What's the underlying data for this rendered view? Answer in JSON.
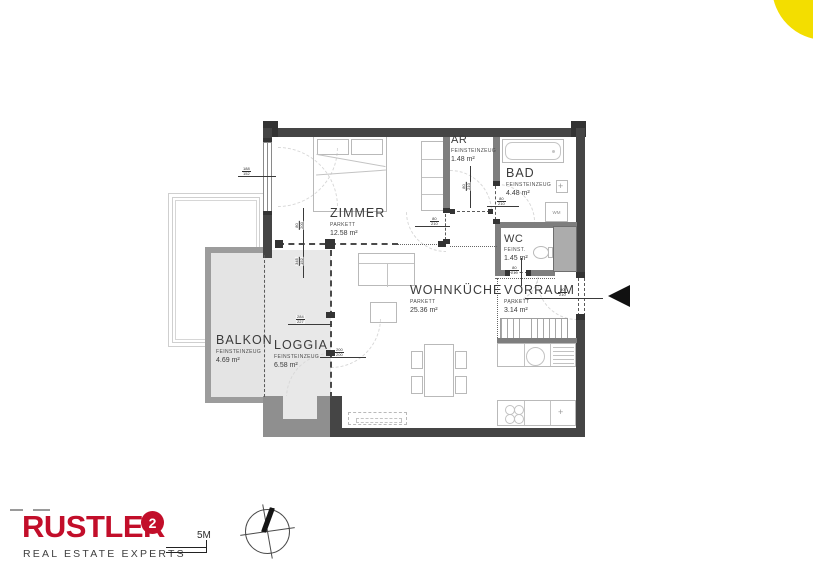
{
  "accent": {
    "corner_circle_color": "#f3de00"
  },
  "branding": {
    "logo_text": "RUSTLER",
    "logo_mark": "2",
    "tagline": "REAL ESTATE EXPERTS",
    "brand_color": "#c20e2a"
  },
  "scale_bar": {
    "label": "5M"
  },
  "rooms": [
    {
      "id": "zimmer",
      "name": "ZIMMER",
      "material": "PARKETT",
      "area": "12.58 m²"
    },
    {
      "id": "ar",
      "name": "AR",
      "material": "FEINSTEINZEUG",
      "area": "1.48 m²"
    },
    {
      "id": "bad",
      "name": "BAD",
      "material": "FEINSTEINZEUG",
      "area": "4.48 m²"
    },
    {
      "id": "wc",
      "name": "WC",
      "material": "FEINST.",
      "area": "1.45 m²"
    },
    {
      "id": "vorraum",
      "name": "VORRAUM",
      "material": "PARKETT",
      "area": "3.14 m²"
    },
    {
      "id": "wohnkueche",
      "name": "WOHNKÜCHE",
      "material": "PARKETT",
      "area": "25.36 m²"
    },
    {
      "id": "balkon",
      "name": "BALKON",
      "material": "FEINSTEINZEUG",
      "area": "4.69 m²"
    },
    {
      "id": "loggia",
      "name": "LOGGIA",
      "material": "FEINSTEINZEUG",
      "area": "6.58 m²"
    }
  ],
  "fixtures": {
    "washing_machine_label": "WM",
    "sink_symbol": "+"
  },
  "dims": {
    "window_left": {
      "top": "188",
      "bottom": "152"
    },
    "zimmer_door": {
      "top": "80",
      "bottom": "200"
    },
    "loggia_fixed": {
      "top": "345",
      "bottom": "152"
    },
    "loggia_door": {
      "top": "284",
      "bottom": "227"
    },
    "loggia_door2": {
      "top": "200",
      "bottom": "200"
    },
    "ar_door": {
      "top": "80",
      "bottom": "210"
    },
    "zimmer_east_door": {
      "top": "80",
      "bottom": "210"
    },
    "bad_door": {
      "top": "80",
      "bottom": "210"
    },
    "wc_door": {
      "top": "80",
      "bottom": "210"
    },
    "entrance_door": {
      "top": "90",
      "bottom": "210"
    }
  }
}
